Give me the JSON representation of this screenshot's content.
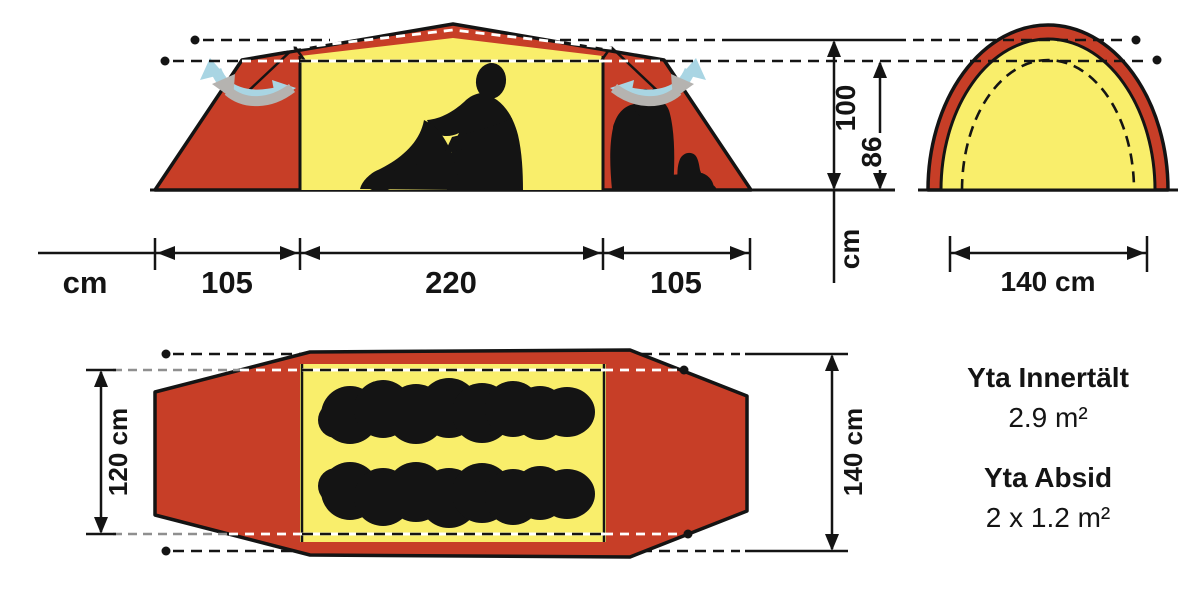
{
  "diagram": {
    "side_view": {
      "unit_label": "cm",
      "width_segments": [
        "105",
        "220",
        "105"
      ],
      "height_outer_cm": "100",
      "height_inner_cm": "86",
      "height_unit_label": "cm"
    },
    "front_view": {
      "width_label": "140 cm"
    },
    "top_view": {
      "inner_width_label": "120 cm",
      "outer_width_label": "140 cm"
    },
    "specs": {
      "inner_tent_area_title": "Yta Innertält",
      "inner_tent_area_value": "2.9 m²",
      "vestibule_area_title": "Yta Absid",
      "vestibule_area_value": "2 x 1.2 m²"
    },
    "colors": {
      "fly_red": "#c73e27",
      "inner_yellow": "#f9ee6b",
      "vent_arrow_blue": "#a9d5e3",
      "vent_arrow_gray": "#b5b3b0",
      "line_black": "#141414"
    }
  }
}
